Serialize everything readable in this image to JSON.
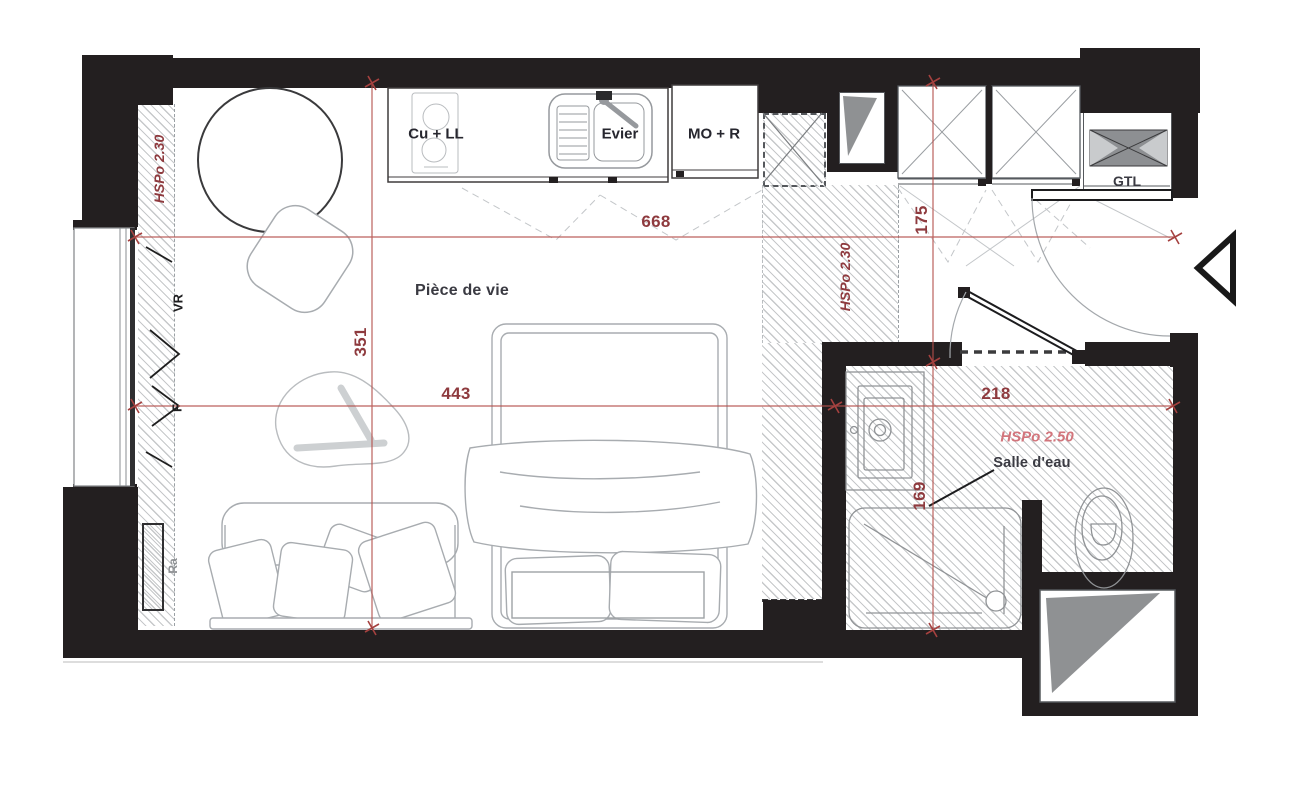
{
  "labels": {
    "rooms": {
      "living": "Pièce de vie",
      "bathroom": "Salle d'eau"
    },
    "kitchen": {
      "cooktop": "Cu + LL",
      "sink": "Evier",
      "micro_fridge": "MO + R"
    },
    "technical": {
      "gtl": "GTL"
    },
    "window_wall": {
      "shutter": "VR",
      "window": "F",
      "radiator": "Ra"
    },
    "ceiling_heights": {
      "left_strip": "HSPo 2.30",
      "entry_strip": "HSPo 2.30",
      "bathroom": "HSPo 2.50"
    }
  },
  "dimensions": {
    "total_width": "668",
    "entry_width": "175",
    "living_length": "351",
    "living_width": "443",
    "bathroom_width": "218",
    "bathroom_length": "169"
  },
  "colors": {
    "wall": "#231f20",
    "dim": "#b5504c",
    "dimlabel": "#8e3a3e",
    "pink": "#d2757c",
    "hatch": "#c6c8ca",
    "furniture": "#a8acb0"
  }
}
